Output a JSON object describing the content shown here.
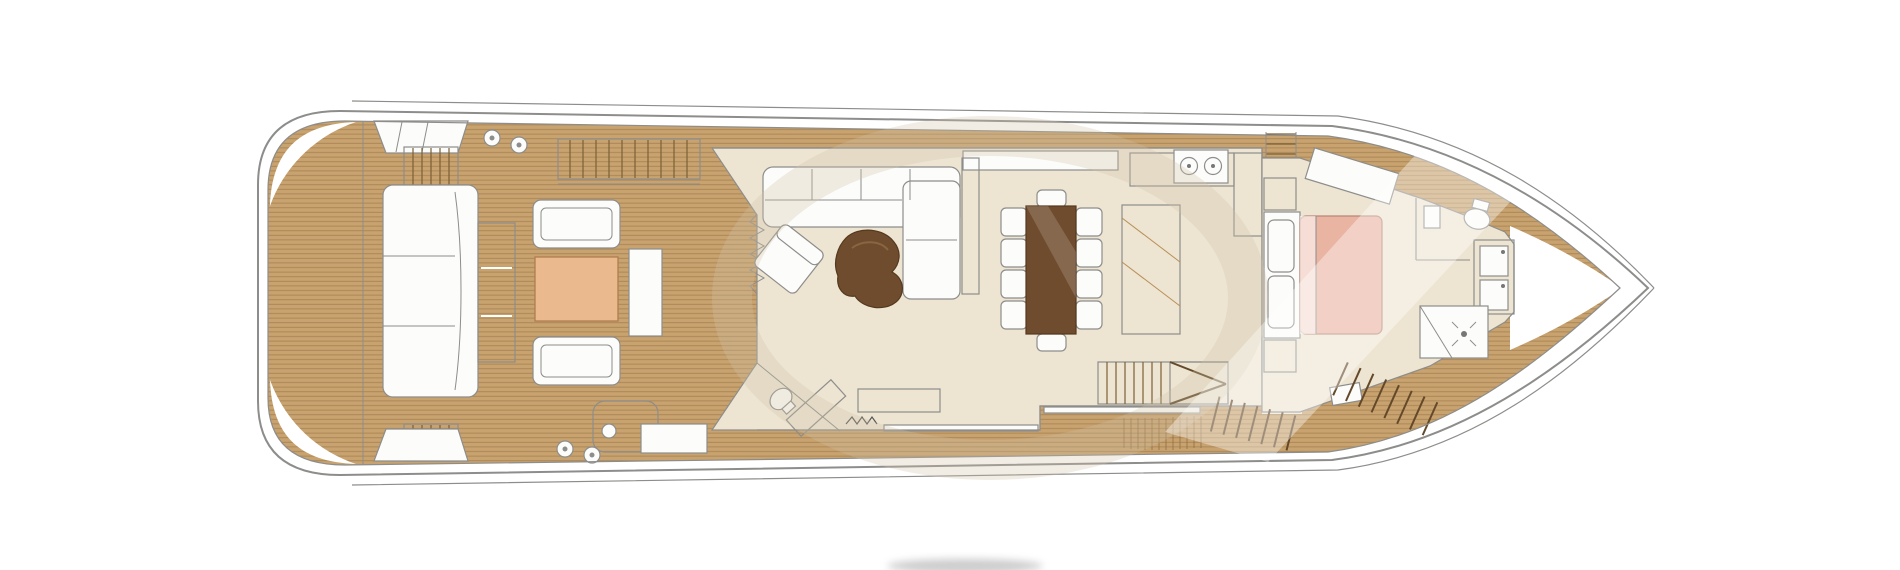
{
  "page": {
    "background": "#ffffff"
  },
  "plan": {
    "type": "yacht-main-deck-floor-plan",
    "view": "top-down, bow pointing right",
    "colors": {
      "hull_line": "#8d8d8b",
      "teak": "#c9a36f",
      "teak_line": "#8a6a3e",
      "interior_floor": "#ede4d2",
      "white_furniture": "#fcfcfa",
      "accent_tan": "#eab98e",
      "wood_mid": "#cda072",
      "wood_dark": "#6f4c2d",
      "bed": "#eab4a2",
      "stair_fill": "#d9c5a0",
      "stair_landing": "#b7976a",
      "stair_small": "#d9b184",
      "table_outline": "#b07c4f",
      "watermark": "#cfc2a9",
      "shadow_smudge": "#9a9a9a"
    },
    "areas": [
      {
        "id": "swim-platform",
        "label": "swim platform"
      },
      {
        "id": "aft-cockpit",
        "label": "aft cockpit lounge"
      },
      {
        "id": "port-side-deck",
        "label": "side deck (top)"
      },
      {
        "id": "starboard-side-deck",
        "label": "side deck (bottom)"
      },
      {
        "id": "salon",
        "label": "main salon"
      },
      {
        "id": "dining-area",
        "label": "dining area"
      },
      {
        "id": "galley",
        "label": "galley"
      },
      {
        "id": "day-head",
        "label": "day head"
      },
      {
        "id": "companionway",
        "label": "stairs to lower deck"
      },
      {
        "id": "master-cabin",
        "label": "forward master cabin"
      },
      {
        "id": "master-bathroom",
        "label": "master bathroom"
      },
      {
        "id": "shower",
        "label": "shower"
      },
      {
        "id": "bow",
        "label": "bow"
      }
    ],
    "furniture": {
      "aft_cockpit": [
        "aft-sofa",
        "sofa-back-cushion",
        "armchair-top",
        "armchair-bottom",
        "coffee-table",
        "side-table",
        "wet-bar",
        "stairs-up-flybridge",
        "side-stairs-top",
        "side-stairs-bottom",
        "cleats"
      ],
      "salon": [
        "l-sofa",
        "lounge-armchair",
        "kidney-coffee-table",
        "tv-cabinet",
        "dining-table",
        "dining-chairs-x10",
        "sideboard",
        "galley-counter",
        "galley-sinks",
        "flybridge-steps",
        "companionway-stairs",
        "day-head-toilet",
        "day-head-cabinet",
        "aft-bench"
      ],
      "master_cabin": [
        "double-bed",
        "headboard-pillows",
        "nightstand-top",
        "nightstand-bottom",
        "window-bench",
        "stool",
        "vanity-twin-basins",
        "toilet",
        "wash-sink",
        "shower-cabin",
        "bow-steps"
      ]
    },
    "watermark": {
      "present": true,
      "description": "large faint circular arc and diagonal light sheen",
      "bottom_smudge": "small gray blur cropped at bottom edge"
    }
  }
}
